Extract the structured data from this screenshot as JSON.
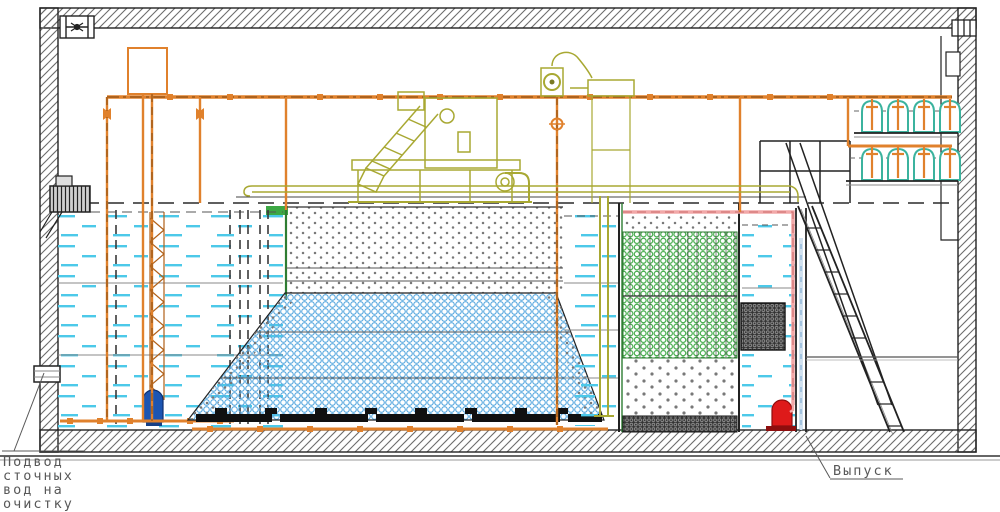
{
  "diagram": {
    "kind": "wastewater-treatment-plant-cross-section",
    "labels": {
      "inlet_lines": [
        "Подвод",
        "сточных",
        "вод на",
        "очистку"
      ],
      "outlet": "Выпуск"
    },
    "components": [
      "building-shell",
      "ventilation-fan-left",
      "ventilation-fan-right",
      "air-main-pipe",
      "expansion-tank",
      "receiving-tank",
      "inlet-wall-pipe",
      "screen-grate-unit",
      "submersible-pump-blue",
      "aeration-tank-media",
      "fine-bubble-aerators",
      "transfer-compartment",
      "biofilter-green-media",
      "clarifier-tank",
      "outlet-pump-red",
      "blower-rack-upper",
      "blower-rack-lower",
      "service-platform",
      "staircase",
      "mechanical-screen-unit",
      "control-cabinet"
    ],
    "colors": {
      "pipe_orange": "#E0812C",
      "pipe_orange_dark": "#7A440E",
      "equipment_olive": "#A8A832",
      "blower_teal": "#3BB39E",
      "media_blue": "#5AA9DF",
      "media_green": "#3DA844",
      "media_gray": "#787878",
      "water_cyan": "#4CC9E9",
      "pipe_pink": "#F2A8A8",
      "pipe_pink_dash": "#C96A6A",
      "pipe_lightblue": "#A3C3DF",
      "pump_blue": "#1C55B2",
      "pump_red": "#DE1A1A",
      "structure": "#222222",
      "hatch": "#6B6B6B",
      "label": "#585858"
    }
  }
}
